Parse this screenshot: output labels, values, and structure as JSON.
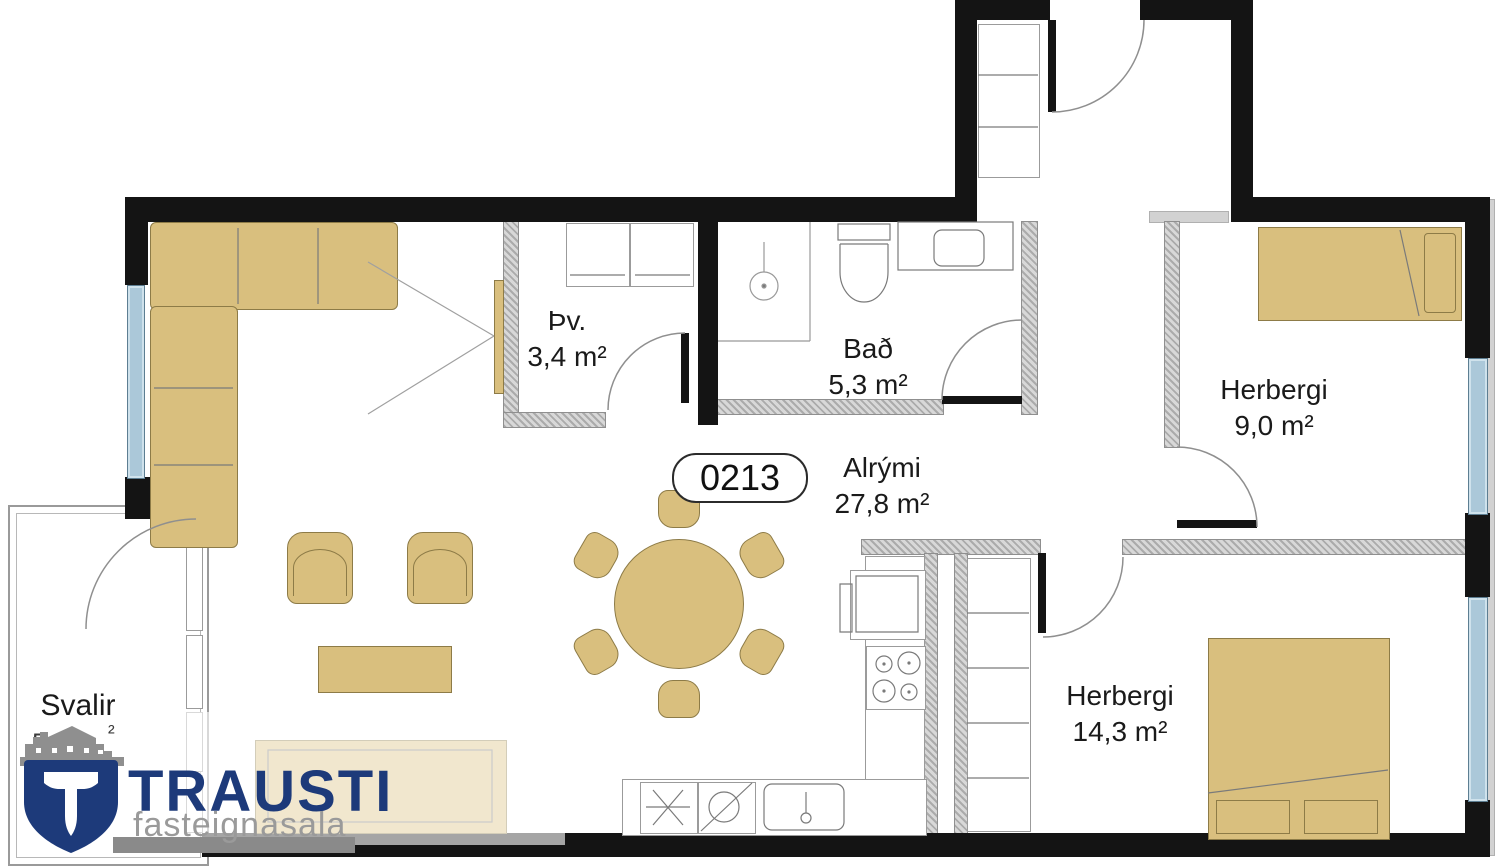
{
  "unit": {
    "number": "0213"
  },
  "rooms": {
    "laundry": {
      "name": "Þv.",
      "area": "3,4 m²"
    },
    "bathroom": {
      "name": "Bað",
      "area": "5,3 m²"
    },
    "living": {
      "name": "Alrými",
      "area": "27,8 m²"
    },
    "bedroom_small": {
      "name": "Herbergi",
      "area": "9,0 m²"
    },
    "bedroom_large": {
      "name": "Herbergi",
      "area": "14,3 m²"
    },
    "balcony": {
      "name": "Svalir",
      "area_fragment_left": "5",
      "area_fragment_right": "²"
    }
  },
  "logo": {
    "brand": "TRAUSTI",
    "tagline": "fasteignasala"
  },
  "colors": {
    "wall": "#141414",
    "interior_wall": "#c2c2c2",
    "furniture": "#d9bf7e",
    "window": "#abc8d9",
    "logo_navy": "#1d3a7a",
    "logo_gray": "#9a9a9a"
  },
  "fixtures": [
    "corner-sofa",
    "armchair",
    "coffee-table",
    "sideboard",
    "tv",
    "dining-table",
    "dining-chair",
    "single-bed",
    "double-bed",
    "wardrobe",
    "entry-closet",
    "washer",
    "dryer",
    "oven",
    "stove",
    "kitchen-sink",
    "dishwasher",
    "fridge",
    "shower",
    "toilet",
    "vanity-sink",
    "window",
    "door-swing",
    "house-watermark",
    "shield-logo"
  ]
}
